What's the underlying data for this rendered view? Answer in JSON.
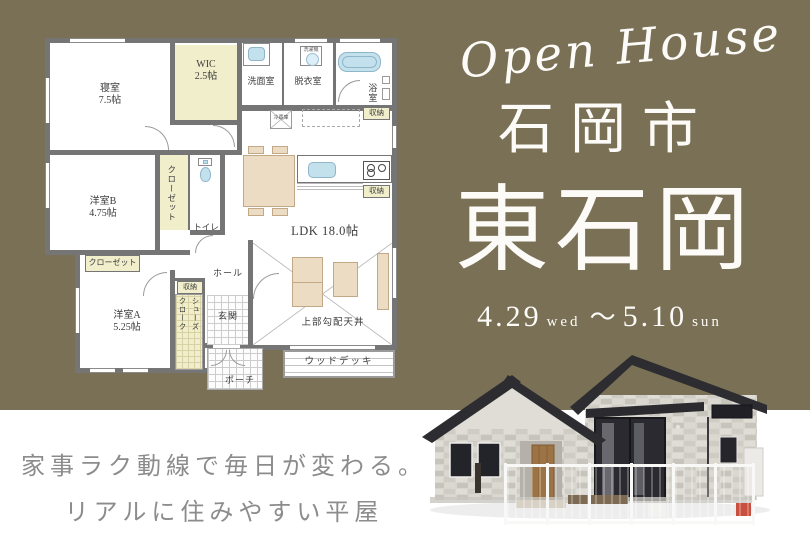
{
  "colors": {
    "olive_bg": "#7a7055",
    "plan_wall": "#757575",
    "plan_cream": "#f1eecb",
    "fixture_blue": "#c3e0ed",
    "furniture_tan": "#ecdcc3",
    "title_white": "#fcfbf8",
    "catch_gray": "#8c8c8c"
  },
  "right_panel": {
    "script_title": "Open House",
    "city": "石岡市",
    "area": "東石岡",
    "date_start_num": "4.29",
    "date_start_day": "wed",
    "date_tilde": "～",
    "date_end_num": "5.10",
    "date_end_day": "sun"
  },
  "catchcopy": {
    "line1": "家事ラク動線で毎日が変わる。",
    "line2": "リアルに住みやすい平屋"
  },
  "floorplan": {
    "rooms": {
      "bedroom_name": "寝室",
      "bedroom_size": "7.5帖",
      "wic_name": "WIC",
      "wic_size": "2.5帖",
      "washroom": "洗面室",
      "dressing": "脱衣室",
      "laundry": "洗濯機",
      "bath": "浴室",
      "storage_bath": "収納",
      "fridge": "冷蔵庫",
      "room_b_name": "洋室B",
      "room_b_size": "4.75帖",
      "closet_b": "クローゼット",
      "toilet": "トイレ",
      "ldk": "LDK 18.0帖",
      "storage_kitchen": "収納",
      "closet_a": "クローゼット",
      "room_a_name": "洋室A",
      "room_a_size": "5.25帖",
      "storage_hall": "収納",
      "shoes_line1": "シューズ",
      "shoes_line2": "クローク",
      "hall": "ホール",
      "entrance": "玄関",
      "porch": "ポーチ",
      "sloped_ceiling": "上部勾配天井",
      "wood_deck": "ウッドデッキ"
    }
  }
}
